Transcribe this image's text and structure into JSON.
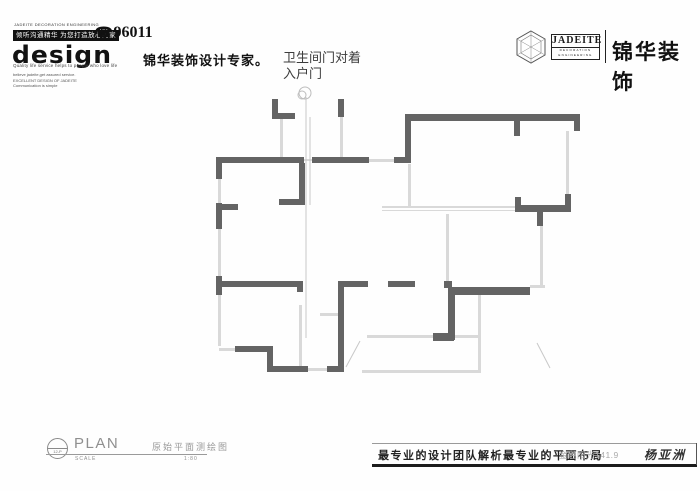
{
  "header": {
    "left": {
      "tiny_top": "JADEITE DECORATION ENGINEERING",
      "boxed_slogan": "倾听沟通精华 为您打造放心的家",
      "phone": "96011",
      "wordmark": "design",
      "tagline_en": "Quality life service helps to people who love life",
      "brand_cn": "锦华装饰设计专家。",
      "small_lines": [
        "believe jadeite,get assured service.",
        "EXCELLENT DESIGN OF JADEITE",
        "Communication is simple"
      ]
    },
    "right": {
      "logo_text": "JADEITE",
      "logo_sub1": "DECORATION",
      "logo_sub2": "ENGINEERING",
      "brand": "锦华装饰"
    }
  },
  "annotation": {
    "line1": "卫生间门对着",
    "line2": "入户门"
  },
  "titleblock": {
    "bubble": "12-P",
    "plan": "PLAN",
    "scale_label": "SCALE",
    "cn_title": "原始平面测绘图",
    "scale_value": "1:80"
  },
  "footer": {
    "slogan": "最专业的设计团队解析最专业的平面布局",
    "project": "金色阳光141.9",
    "designer": "杨亚洲"
  },
  "floorplan": {
    "wall_color": "#646464",
    "window_color": "#d9d9d9",
    "line_color": "#c8c8c8",
    "walls": [
      [
        272,
        99,
        6,
        20
      ],
      [
        272,
        113,
        23,
        6
      ],
      [
        338,
        99,
        6,
        18
      ],
      [
        405,
        114,
        6,
        49
      ],
      [
        408,
        114,
        168,
        7
      ],
      [
        574,
        114,
        6,
        17
      ],
      [
        514,
        121,
        6,
        15
      ],
      [
        216,
        157,
        6,
        22
      ],
      [
        216,
        157,
        88,
        6
      ],
      [
        312,
        157,
        57,
        6
      ],
      [
        394,
        157,
        17,
        6
      ],
      [
        299,
        163,
        6,
        42
      ],
      [
        279,
        199,
        26,
        6
      ],
      [
        216,
        203,
        6,
        26
      ],
      [
        222,
        204,
        16,
        6
      ],
      [
        216,
        276,
        6,
        19
      ],
      [
        222,
        281,
        81,
        6
      ],
      [
        297,
        281,
        6,
        11
      ],
      [
        338,
        281,
        6,
        91
      ],
      [
        344,
        281,
        24,
        6
      ],
      [
        388,
        281,
        27,
        6
      ],
      [
        444,
        281,
        8,
        7
      ],
      [
        448,
        287,
        82,
        8
      ],
      [
        448,
        295,
        7,
        45
      ],
      [
        433,
        333,
        21,
        8
      ],
      [
        235,
        346,
        38,
        6
      ],
      [
        267,
        352,
        6,
        20
      ],
      [
        267,
        366,
        41,
        6
      ],
      [
        327,
        366,
        17,
        6
      ],
      [
        565,
        194,
        6,
        18
      ],
      [
        515,
        205,
        56,
        7
      ],
      [
        515,
        197,
        6,
        8
      ],
      [
        537,
        212,
        6,
        14
      ]
    ],
    "windows": [
      [
        280,
        119,
        3,
        38
      ],
      [
        340,
        117,
        3,
        40
      ],
      [
        218,
        179,
        3,
        24
      ],
      [
        218,
        229,
        3,
        47
      ],
      [
        218,
        295,
        3,
        51
      ],
      [
        219,
        348,
        16,
        3
      ],
      [
        304,
        159,
        8,
        2
      ],
      [
        368,
        159,
        26,
        3
      ],
      [
        408,
        164,
        3,
        43
      ],
      [
        566,
        131,
        3,
        63
      ],
      [
        540,
        226,
        3,
        59
      ],
      [
        530,
        285,
        15,
        3
      ],
      [
        446,
        214,
        3,
        67
      ],
      [
        382,
        206,
        133,
        2
      ],
      [
        382,
        210,
        133,
        1
      ],
      [
        478,
        294,
        3,
        78
      ],
      [
        362,
        370,
        119,
        3
      ],
      [
        367,
        335,
        66,
        3
      ],
      [
        455,
        335,
        25,
        3
      ],
      [
        299,
        305,
        3,
        61
      ],
      [
        320,
        313,
        18,
        3
      ],
      [
        308,
        368,
        20,
        3
      ]
    ],
    "lines": [
      [
        306,
        97,
        306,
        338
      ],
      [
        310,
        117,
        310,
        205
      ],
      [
        360,
        341,
        346,
        367
      ],
      [
        537,
        343,
        550,
        368
      ]
    ],
    "sketch_circles": [
      [
        305,
        93,
        6
      ],
      [
        302,
        95,
        4
      ]
    ]
  }
}
